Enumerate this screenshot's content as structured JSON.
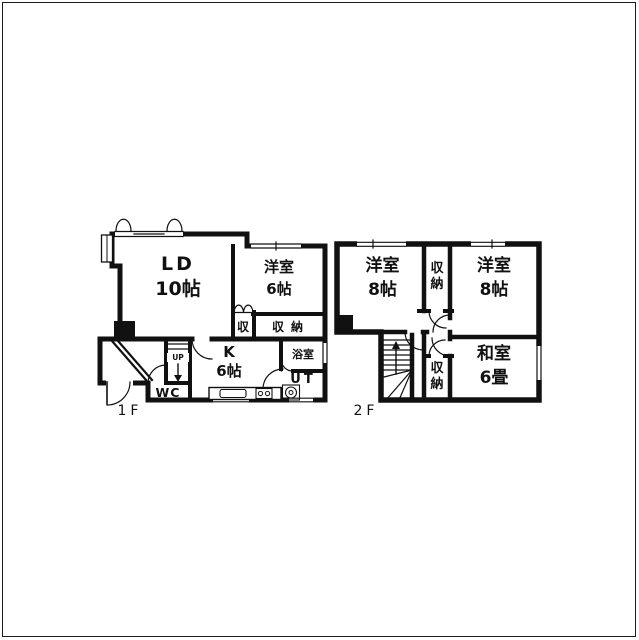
{
  "colors": {
    "ink": "#111111",
    "bg": "#ffffff"
  },
  "floor1": {
    "label": "1F",
    "ld": {
      "l1": "LD",
      "l2": "10帖"
    },
    "yoshitsu": {
      "l1": "洋室",
      "l2": "6帖"
    },
    "closet_small": "収",
    "closet": "収納",
    "kitchen": {
      "l1": "K",
      "l2": "6帖"
    },
    "bath": "浴室",
    "utility": "UT",
    "toilet": "WC",
    "stairs": "UP"
  },
  "floor2": {
    "label": "2F",
    "yoshitsu_left": {
      "l1": "洋室",
      "l2": "8帖"
    },
    "yoshitsu_right": {
      "l1": "洋室",
      "l2": "8帖"
    },
    "washitsu": {
      "l1": "和室",
      "l2": "6畳"
    },
    "closet_top": "収納",
    "closet_bottom": "収納"
  }
}
